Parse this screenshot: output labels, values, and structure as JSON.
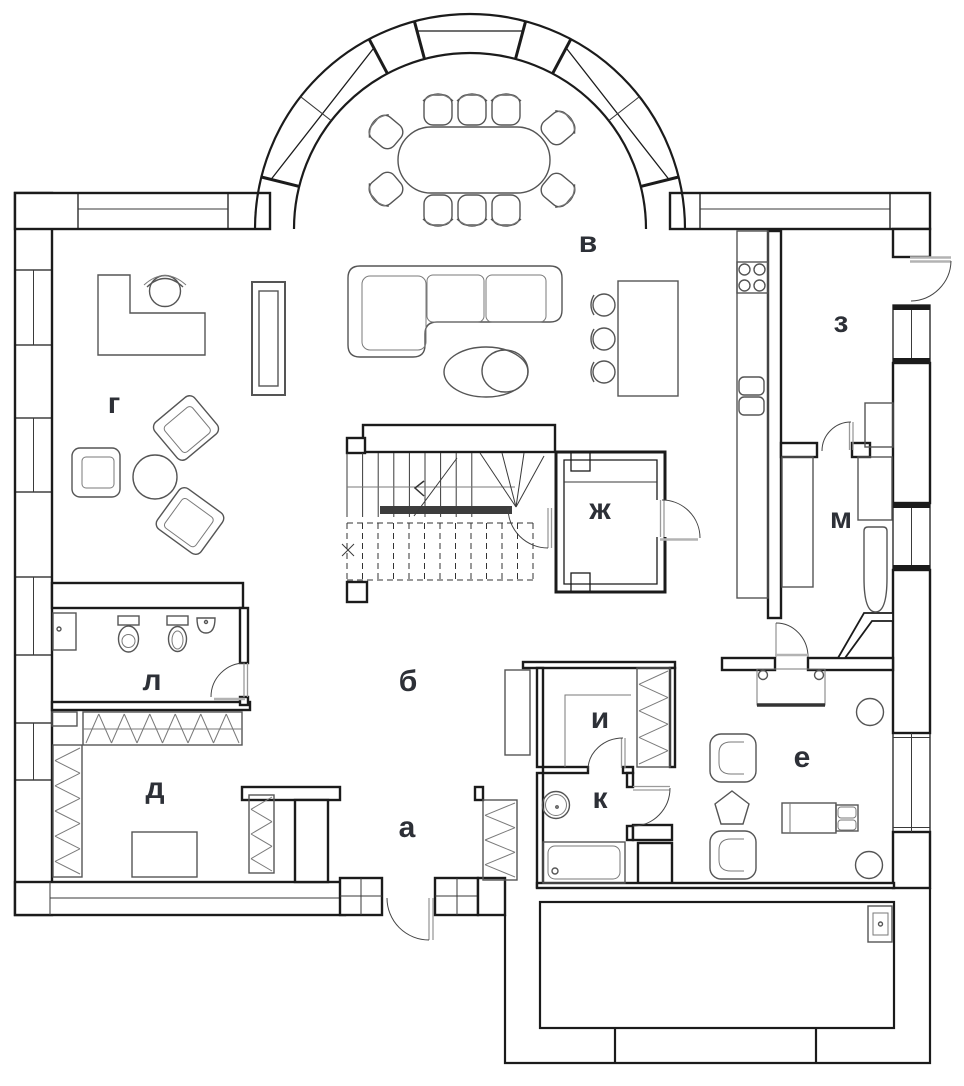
{
  "plan": {
    "type": "architectural floor plan",
    "background_color": "#ffffff",
    "wall_color": "#1b1b1b",
    "furniture_color": "#555555",
    "threshold_color": "#b3b3b3",
    "label_color": "#2d3037",
    "rooms": [
      {
        "key": "a",
        "label": "а"
      },
      {
        "key": "b",
        "label": "б"
      },
      {
        "key": "v",
        "label": "в"
      },
      {
        "key": "g",
        "label": "г"
      },
      {
        "key": "d",
        "label": "д"
      },
      {
        "key": "e",
        "label": "е"
      },
      {
        "key": "zh",
        "label": "ж"
      },
      {
        "key": "z",
        "label": "з"
      },
      {
        "key": "i",
        "label": "и"
      },
      {
        "key": "k",
        "label": "к"
      },
      {
        "key": "l",
        "label": "л"
      },
      {
        "key": "m",
        "label": "м"
      }
    ]
  }
}
